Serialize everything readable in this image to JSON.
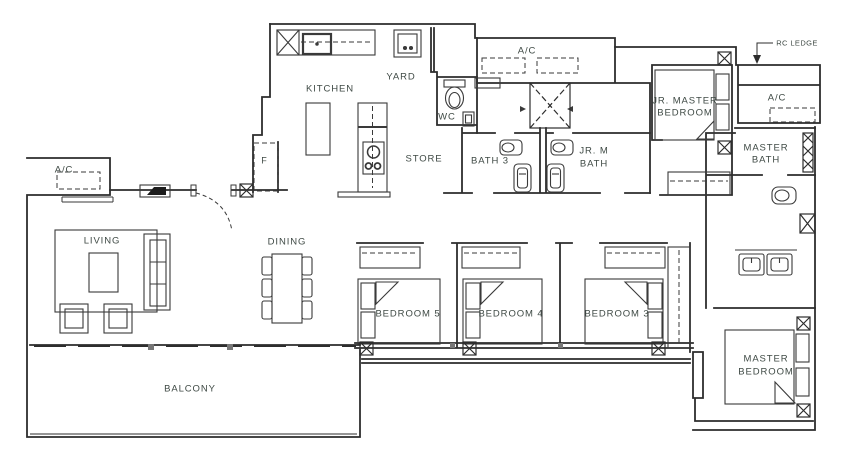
{
  "title": "5-Bedroom Unit Floor Plan",
  "colors": {
    "wall_line": "#2d2d2d",
    "furniture_line": "#3a3a3a",
    "label_text": "#3f4a45",
    "background": "#ffffff"
  },
  "labels": {
    "kitchen": "KITCHEN",
    "yard": "YARD",
    "wc": "WC",
    "store": "STORE",
    "bath3": "BATH 3",
    "jr_m_bath_line1": "JR. M",
    "jr_m_bath_line2": "BATH",
    "jr_master_bedroom_line1": "JR. MASTER",
    "jr_master_bedroom_line2": "BEDROOM",
    "master_bath_line1": "MASTER",
    "master_bath_line2": "BATH",
    "master_bedroom_line1": "MASTER",
    "master_bedroom_line2": "BEDROOM",
    "living": "LIVING",
    "dining": "DINING",
    "bedroom5": "BEDROOM 5",
    "bedroom4": "BEDROOM 4",
    "bedroom3": "BEDROOM 3",
    "balcony": "BALCONY",
    "ac_left": "A/C",
    "ac_top": "A/C",
    "ac_right": "A/C",
    "rc_ledge": "RC LEDGE",
    "fridge": "F"
  }
}
